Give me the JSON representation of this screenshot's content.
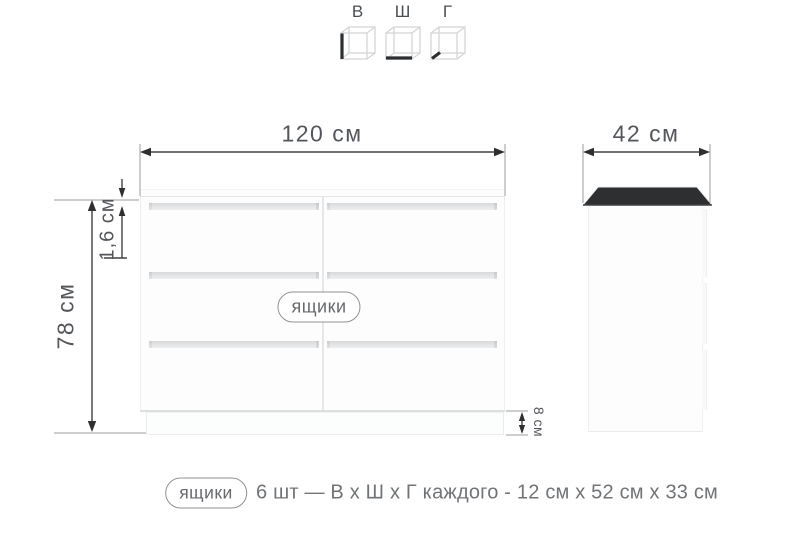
{
  "legend": {
    "items": [
      {
        "label": "В",
        "icon": "height-cube-icon"
      },
      {
        "label": "Ш",
        "icon": "width-cube-icon"
      },
      {
        "label": "Г",
        "icon": "depth-cube-icon"
      }
    ]
  },
  "front_view": {
    "width": "120 см",
    "height": "78 см",
    "top_thickness": "1,6 см",
    "plinth_height": "8 см",
    "drawers_badge": "ящики",
    "drawer_rows": 3,
    "drawer_columns": 2
  },
  "side_view": {
    "depth": "42 см"
  },
  "caption": {
    "badge": "ящики",
    "text": "6 шт — В х Ш х Г каждого - 12 см х 52 см х 33 см"
  },
  "colors": {
    "background": "#ffffff",
    "dimension_line": "#404244",
    "dimension_text": "#53565a",
    "caption_text": "#717477",
    "badge_border": "#8f9295",
    "furniture_fill": "#fdfdfd",
    "furniture_edge": "#eaecee",
    "groove": "#d7d9db",
    "cube_wireframe": "#d3d5d7",
    "cube_bold_edge": "#2c2e30"
  }
}
